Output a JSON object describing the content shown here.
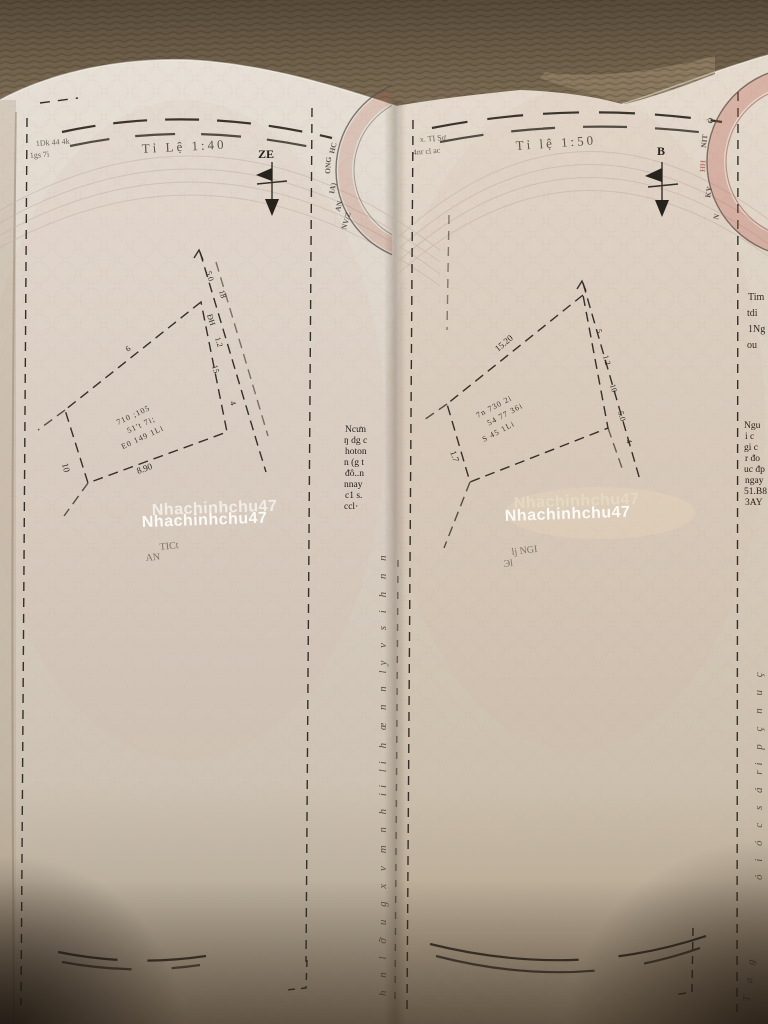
{
  "photo": {
    "background_color": "#8a795f",
    "paper_color": "#ddd5c9",
    "stamp_red": "#b05548",
    "ink_color": "#33302a"
  },
  "left_page": {
    "corner_note": {
      "line1": "1Dk 44 4k",
      "line2": "1gs 7i"
    },
    "scale_caption": "Tỉ Lệ 1:40",
    "compass_label": "ZE",
    "stamp_letters": [
      "HC",
      "ONG",
      "IA)",
      "AN",
      "NV/Z"
    ],
    "parcel": {
      "road_labels": [
        "5.0",
        "18",
        "ĐH",
        "1.2",
        "15",
        "4"
      ],
      "dim_bottom": "8.90",
      "dim_left": "10",
      "edge_tick": "6",
      "inner_lines": [
        "710 ;105",
        "51't 7i;",
        "E0 149 1Li"
      ]
    },
    "watermark": {
      "text": "Nhachinhchu47",
      "sub1": "TICt",
      "sub2": "AN"
    },
    "fold_text_lines": [
      "Ncưn",
      "ŋ dg c",
      "hoton",
      "n (g t",
      "đô..n",
      "nnay",
      "c1 s.",
      "ccl·"
    ]
  },
  "right_page": {
    "corner_note": {
      "line1": "x. TỊ Sơ",
      "line2": "4nr cl ac"
    },
    "scale_caption": "Tỉ lệ 1:50",
    "compass_label": "B",
    "stamp_letters": [
      "Ò",
      "NIT",
      "HH",
      "KY",
      "N"
    ],
    "parcel": {
      "road_labels": [
        "5",
        "1.2",
        "10",
        "5.0",
        "4"
      ],
      "dim_top": "15.20",
      "dim_left": "1.7",
      "inner_lines": [
        "7n 730 2i",
        "54 77 36i",
        "S 45 1Li"
      ]
    },
    "watermark": {
      "text": "Nhachinhchu47",
      "sub1": "lj NGI",
      "sub2": "Эl"
    },
    "edge_text_lines": [
      "Ngu",
      "i c",
      "gi c",
      "r đo",
      "uc đp",
      "ngay",
      "51.B8",
      "3AY"
    ]
  },
  "edge_strip": {
    "partial_words": [
      "Tim",
      "tdi",
      "1Ng",
      "ou"
    ],
    "cursive_line": "ó i ó c s á ri p ç n u ç",
    "corner_cursive": "T a g"
  },
  "fold": {
    "cursive_line": "h n l ỡ u g x v m n h ii li h œ n n ly v s i h n n"
  }
}
